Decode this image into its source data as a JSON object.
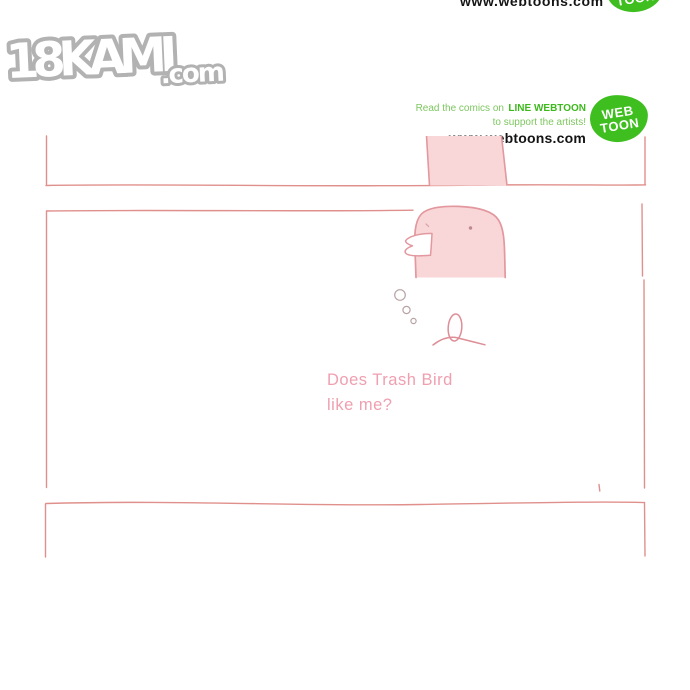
{
  "site_logo": {
    "text_main": "18KAMI",
    "text_suffix": ".com",
    "color_outline": "#b2b2b2"
  },
  "top_edge": {
    "url_text": "www.webtoons.com",
    "blob_line1": "WEB",
    "blob_line2": "TOON"
  },
  "webtoon_notice": {
    "line1_regular": "Read the comics on",
    "line1_bold": "LINE WEBTOON",
    "line2": "to support the artists!",
    "url": "www.webtoons.com",
    "blob_line1": "WEB",
    "blob_line2": "TOON",
    "color_green": "#3eb91d",
    "color_green_light": "#7dc75f",
    "color_blob": "#3ebf1f",
    "color_url": "#141414"
  },
  "comic": {
    "caption_line1": "Does Trash Bird",
    "caption_line2": "like me?",
    "colors": {
      "caption": "#ef9fb0",
      "panel_border": "#e0908c",
      "figure_fill": "#f9d7d9",
      "figure_outline": "#e2989e",
      "beak_fill": "#ffffff",
      "bubble_outline": "#b7a2a4",
      "sprout_outline": "#dd8e97"
    }
  }
}
